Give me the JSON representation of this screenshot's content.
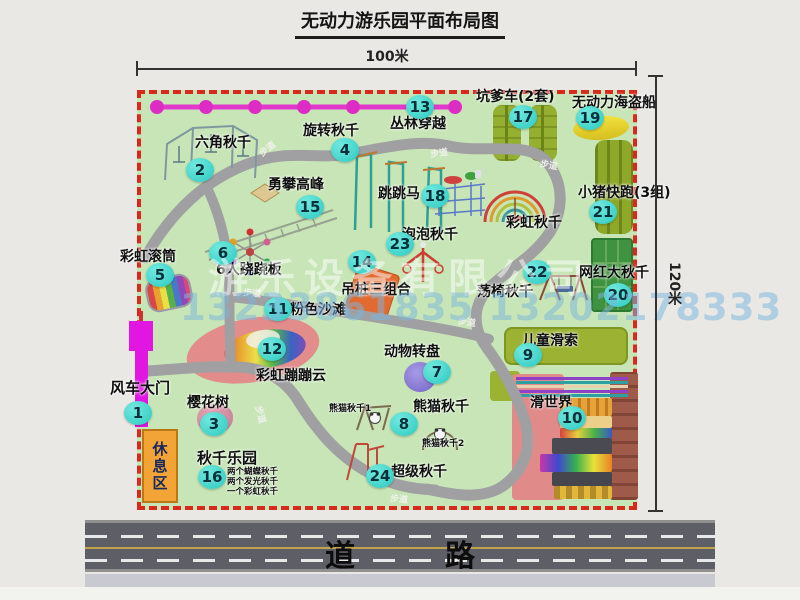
{
  "title": "无动力游乐园平面布局图",
  "dimensions": {
    "width": "100米",
    "height": "120米"
  },
  "road": {
    "label": "道　路"
  },
  "watermark": {
    "company": "游乐设备有限公司",
    "phone": "13233861835 13202178333"
  },
  "path_label": "步道",
  "attractions": [
    {
      "num": "1",
      "name": "风车大门"
    },
    {
      "num": "2",
      "name": "六角秋千"
    },
    {
      "num": "3",
      "name": "樱花树"
    },
    {
      "num": "4",
      "name": "旋转秋千"
    },
    {
      "num": "5",
      "name": "彩虹滚筒"
    },
    {
      "num": "6",
      "name": "6人跷跷板"
    },
    {
      "num": "7",
      "name": "动物转盘"
    },
    {
      "num": "8",
      "name": "熊猫秋千"
    },
    {
      "num": "9",
      "name": "儿童滑索"
    },
    {
      "num": "10",
      "name": "滑世界"
    },
    {
      "num": "11",
      "name": "粉色沙滩"
    },
    {
      "num": "12",
      "name": "彩虹蹦蹦云"
    },
    {
      "num": "13",
      "name": "丛林穿越"
    },
    {
      "num": "14",
      "name": "吊桩三组合"
    },
    {
      "num": "15",
      "name": "勇攀高峰"
    },
    {
      "num": "16",
      "name": "秋千乐园"
    },
    {
      "num": "17",
      "name": "坑爹车(2套)"
    },
    {
      "num": "18",
      "name": "跳跳马"
    },
    {
      "num": "19",
      "name": "无动力海盗船"
    },
    {
      "num": "20",
      "name": "网红大秋千"
    },
    {
      "num": "21",
      "name": "小猪快跑(3组)"
    },
    {
      "num": "22",
      "name": "荡椅秋千"
    },
    {
      "num": "23",
      "name": "泡泡秋千"
    },
    {
      "num": "24",
      "name": "超级秋千"
    }
  ],
  "extra_labels": {
    "rainbow_swing": "彩虹秋千",
    "rest_area": "休息区",
    "panda_swing_1": "熊猫秋千1",
    "panda_swing_2": "熊猫秋千2",
    "swing_park_notes": [
      "两个蝴蝶秋千",
      "两个发光秋千",
      "一个彩虹秋千"
    ]
  },
  "colors": {
    "map_green": "#c7e5b6",
    "border_red": "#d8291f",
    "badge_teal": "#38d7cc",
    "zipline_magenta": "#e238ce",
    "gate_magenta": "#e216e2",
    "rest_area_orange": "#f2a437",
    "road_asphalt": "#5e5e66"
  }
}
